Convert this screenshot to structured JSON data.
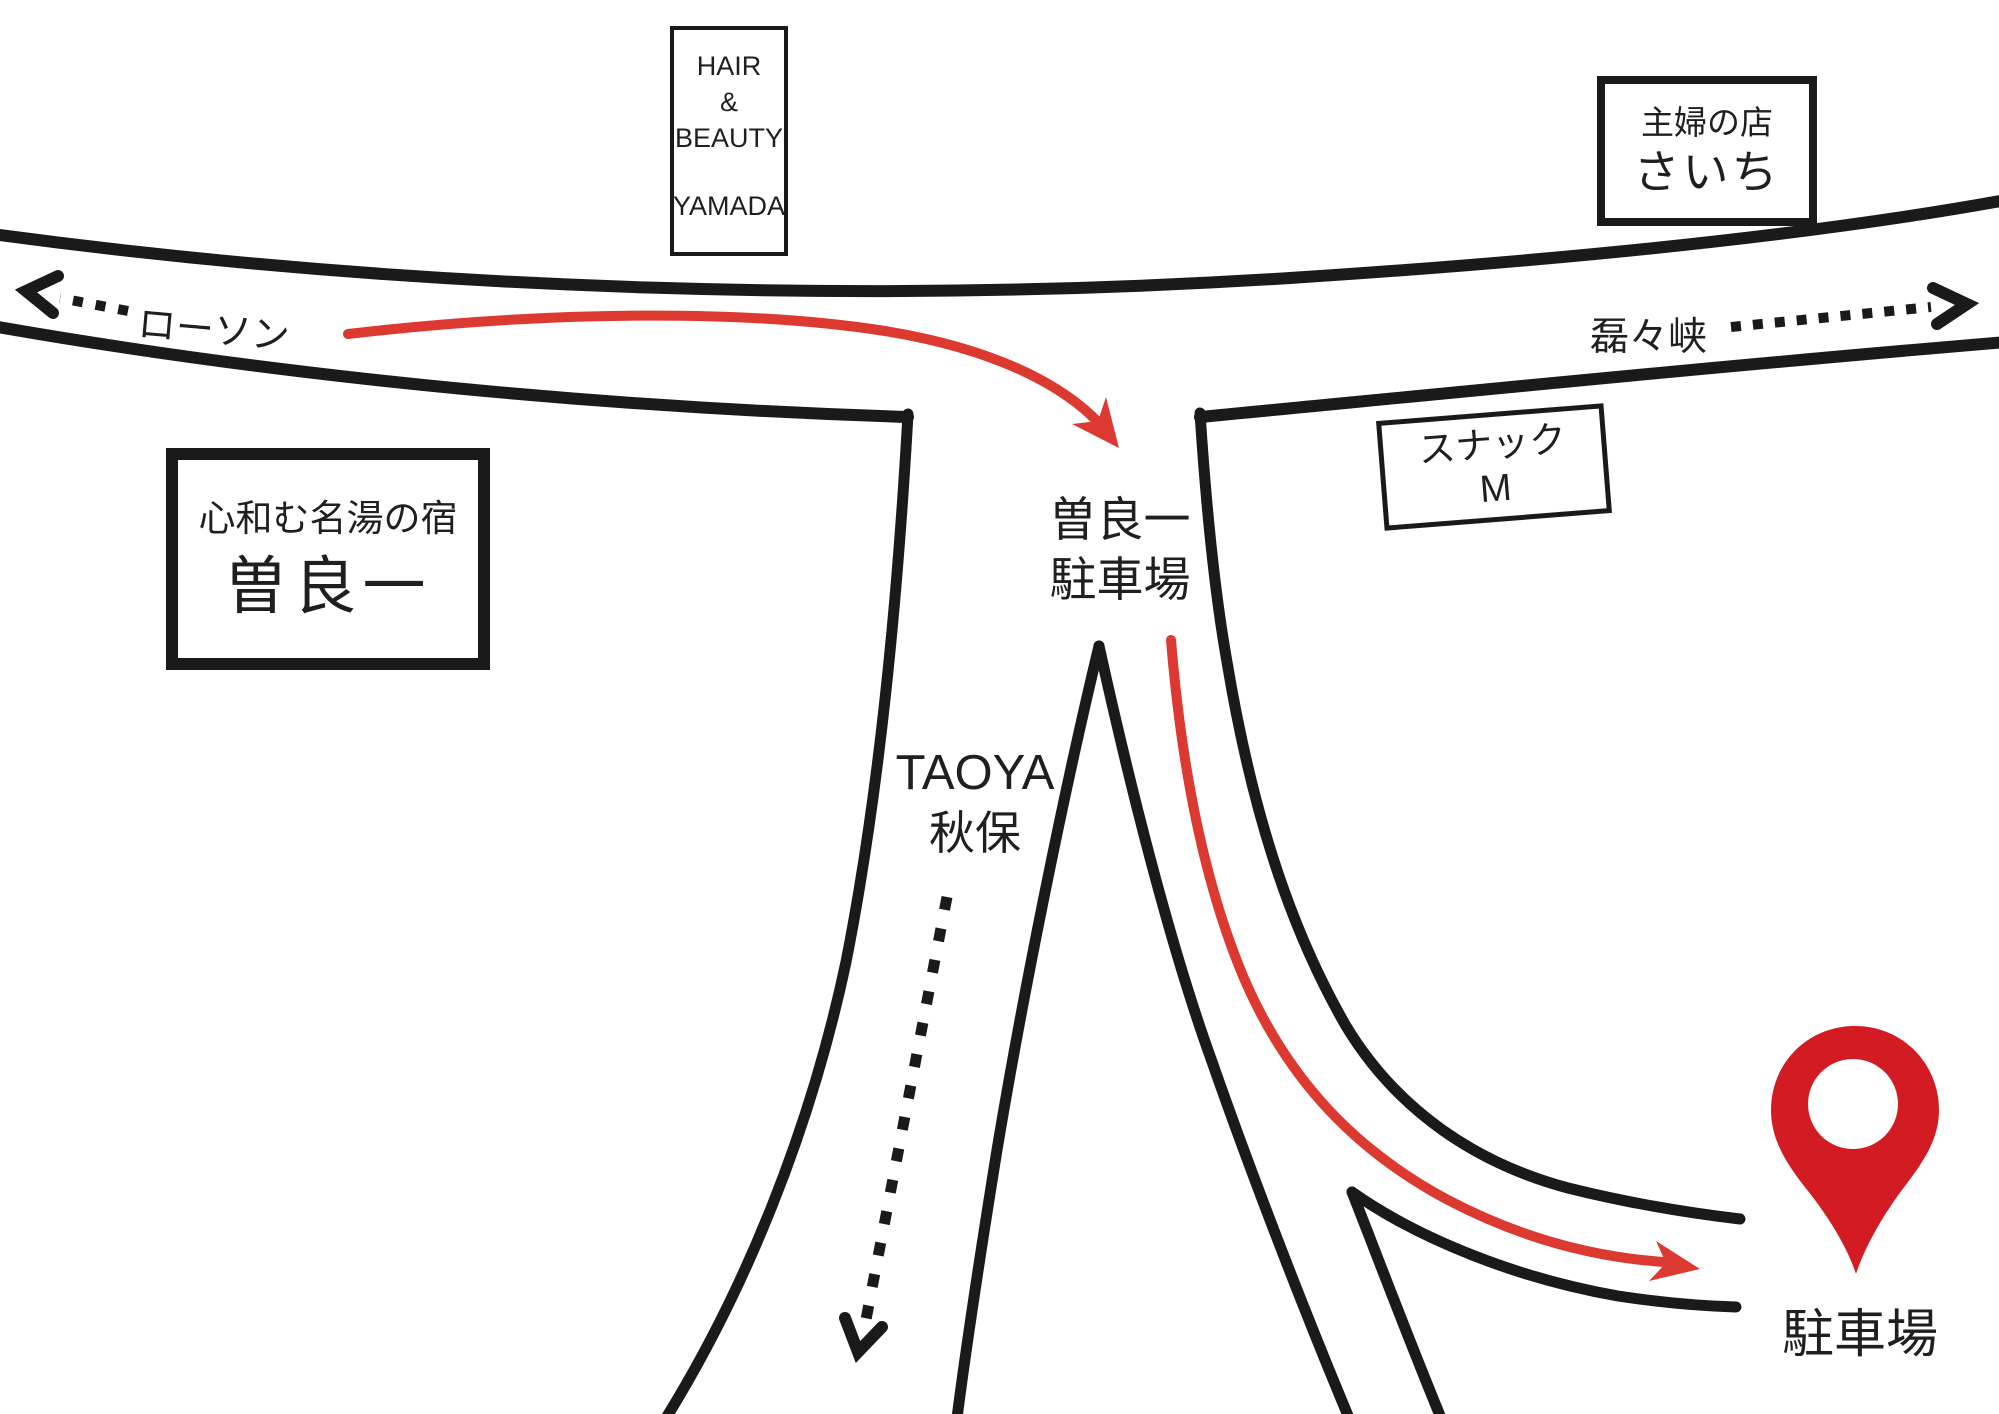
{
  "labels": {
    "hair_salon": {
      "line1": "HAIR",
      "line2": "&",
      "line3": "BEAUTY",
      "line4": "YAMADA"
    },
    "saichi": {
      "line1": "主婦の店",
      "line2": "さいち"
    },
    "lawson": "ローソン",
    "rairaikyo": "磊々峡",
    "ryokan": {
      "line1": "心和む名湯の宿",
      "line2": "曽良一"
    },
    "snack_m": {
      "line1": "スナック",
      "line2": "M"
    },
    "taoya": {
      "line1": "TAOYA",
      "line2": "秋保"
    },
    "soraichi_parking": {
      "line1": "曽良一",
      "line2": "駐車場"
    },
    "parking": "駐車場"
  },
  "icons": {
    "destination_pin": "map-pin-icon",
    "lawson_direction": "dotted-arrow-left-icon",
    "rairaikyo_direction": "dotted-arrow-right-icon",
    "taoya_direction": "dotted-arrow-down-icon",
    "route": "red-route-arrow-icon"
  },
  "colors": {
    "ink": "#1a1a1a",
    "route": "#dc3a31",
    "pin": "#d31b23",
    "text": "#1f1f1f",
    "background": "#ffffff"
  }
}
